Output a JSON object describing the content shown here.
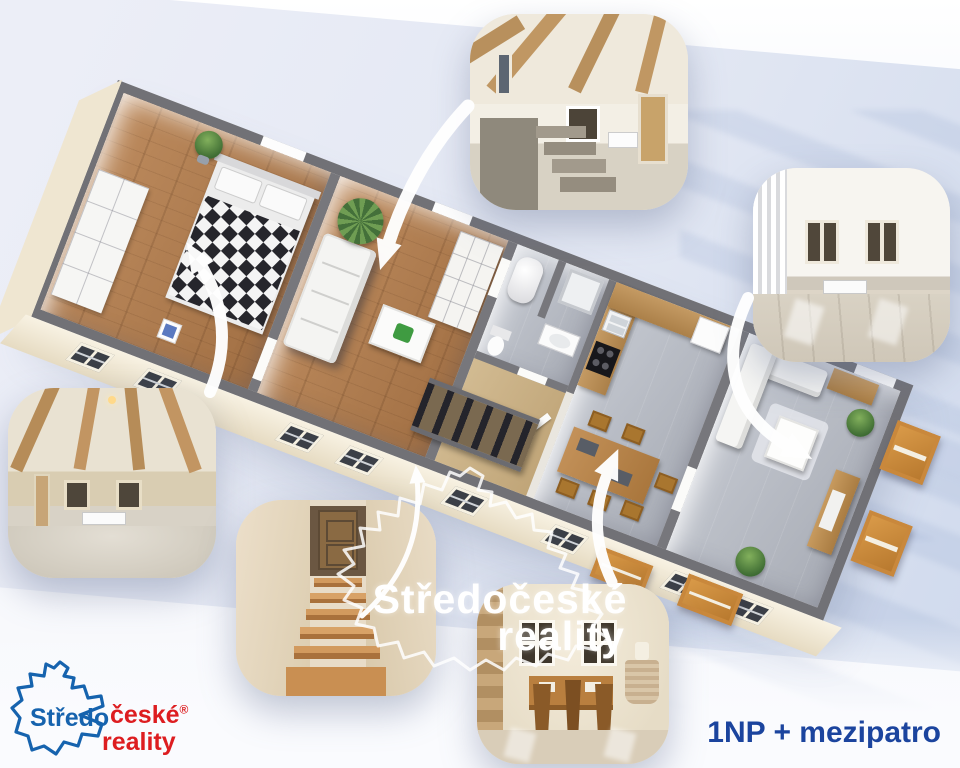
{
  "branding": {
    "logo": {
      "word_blue": "Středo",
      "word_red": "české",
      "registered_mark": "®",
      "word_red2": "reality"
    },
    "watermark": {
      "line1": "Středočeské",
      "line2": "reality"
    }
  },
  "caption": {
    "label": "1NP + mezipatro"
  },
  "colors": {
    "logo_blue": "#1663ae",
    "logo_red": "#dd1d20",
    "caption_blue": "#1b449e",
    "wall_gray": "#717176",
    "facade_cream": "#f2ebdb",
    "wood_floor": "#ad7c50",
    "tile_floor": "#b7bac1",
    "hall_floor": "#c9b28c",
    "shelf_wood": "#c8883d",
    "background_tint": "#e2e7f3"
  },
  "floor_plan": {
    "label": "3d-floor-plan-1np-mezipatro",
    "rooms": [
      "bedroom",
      "living-room",
      "bathroom",
      "hallway-stairs",
      "kitchen-dining",
      "living-room-2"
    ]
  },
  "photos": [
    {
      "name": "mezzanine-room-with-stairs"
    },
    {
      "name": "empty-room-two-windows"
    },
    {
      "name": "beamed-ceiling-room"
    },
    {
      "name": "wooden-staircase"
    },
    {
      "name": "dining-room"
    }
  ]
}
